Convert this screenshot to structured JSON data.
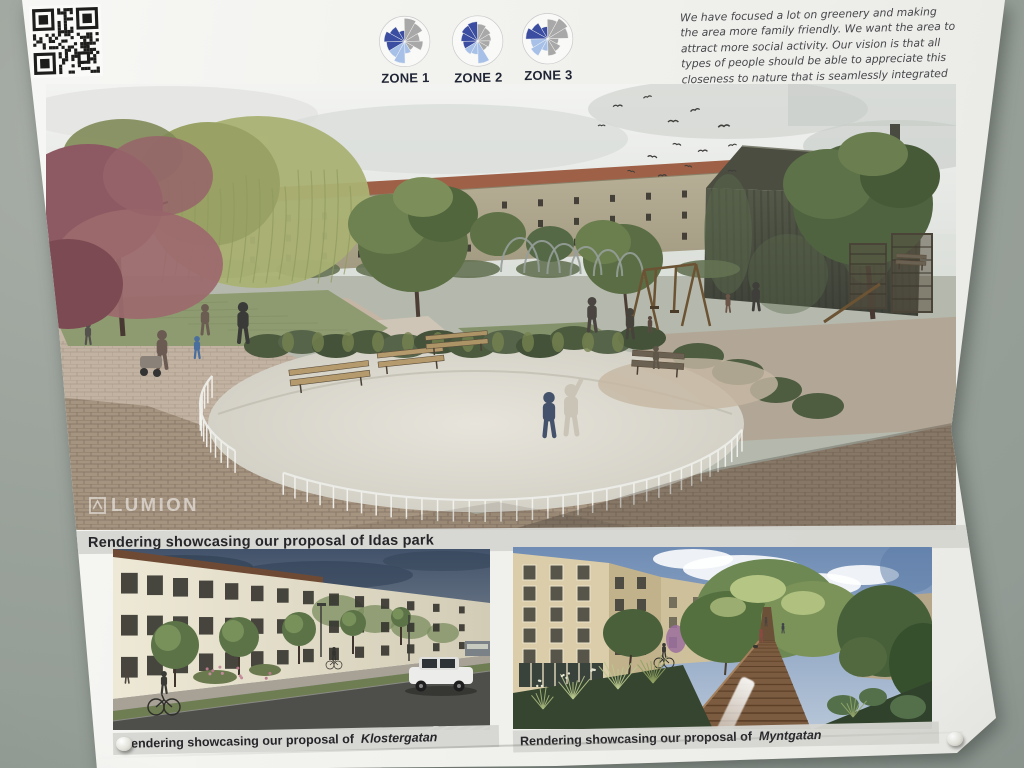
{
  "colors": {
    "zone_dark": "#3a4da0",
    "zone_light": "#a6c0e8",
    "zone_gray": "#a8a8a8",
    "wall": "#9aa29b",
    "caption_bg": "#d5d5d1"
  },
  "poster": {
    "qr_icon": "qr-code",
    "intro": {
      "text_before_bold": "We have focused a lot on greenery and making the area more family friendly. We want the area to attract more social activity. Our vision is that all types of people should be able to appreciate this closeness to nature that is seamlessly integrated into this ",
      "text_bold": "urban space",
      "text_after": "."
    },
    "main_rendering": {
      "watermark": "LUMION",
      "caption": "Rendering showcasing our proposal of Idas park"
    },
    "bottom_left_rendering": {
      "caption_prefix": "Rendering showcasing our proposal of",
      "caption_name": "Klostergatan"
    },
    "bottom_right_rendering": {
      "caption_prefix": "Rendering showcasing our proposal of",
      "caption_name": "Myntgatan"
    }
  },
  "chart_data": [
    {
      "type": "rose",
      "title": "ZONE 1",
      "segment_degrees": 30,
      "values": [
        0.95,
        0.85,
        0.62,
        0.75,
        0.42,
        0.5,
        0.9,
        0.75,
        0.75,
        0.85,
        0.7,
        0.45
      ],
      "colors": [
        "gray",
        "gray",
        "gray",
        "gray",
        "gray",
        "light",
        "light",
        "light",
        "dark",
        "dark",
        "dark",
        "dark"
      ]
    },
    {
      "type": "rose",
      "title": "ZONE 2",
      "segment_degrees": 30,
      "values": [
        0.7,
        0.62,
        0.55,
        0.5,
        0.45,
        0.92,
        0.55,
        0.62,
        0.6,
        0.68,
        0.75,
        0.8
      ],
      "colors": [
        "gray",
        "gray",
        "gray",
        "gray",
        "gray",
        "light",
        "light",
        "light",
        "dark",
        "dark",
        "dark",
        "dark"
      ]
    },
    {
      "type": "rose",
      "title": "ZONE 3",
      "segment_degrees": 30,
      "values": [
        0.8,
        0.95,
        0.85,
        0.45,
        0.6,
        0.7,
        0.5,
        0.8,
        0.7,
        0.9,
        0.75,
        0.5
      ],
      "colors": [
        "gray",
        "gray",
        "gray",
        "gray",
        "gray",
        "gray",
        "light",
        "light",
        "light",
        "dark",
        "dark",
        "dark"
      ]
    }
  ]
}
